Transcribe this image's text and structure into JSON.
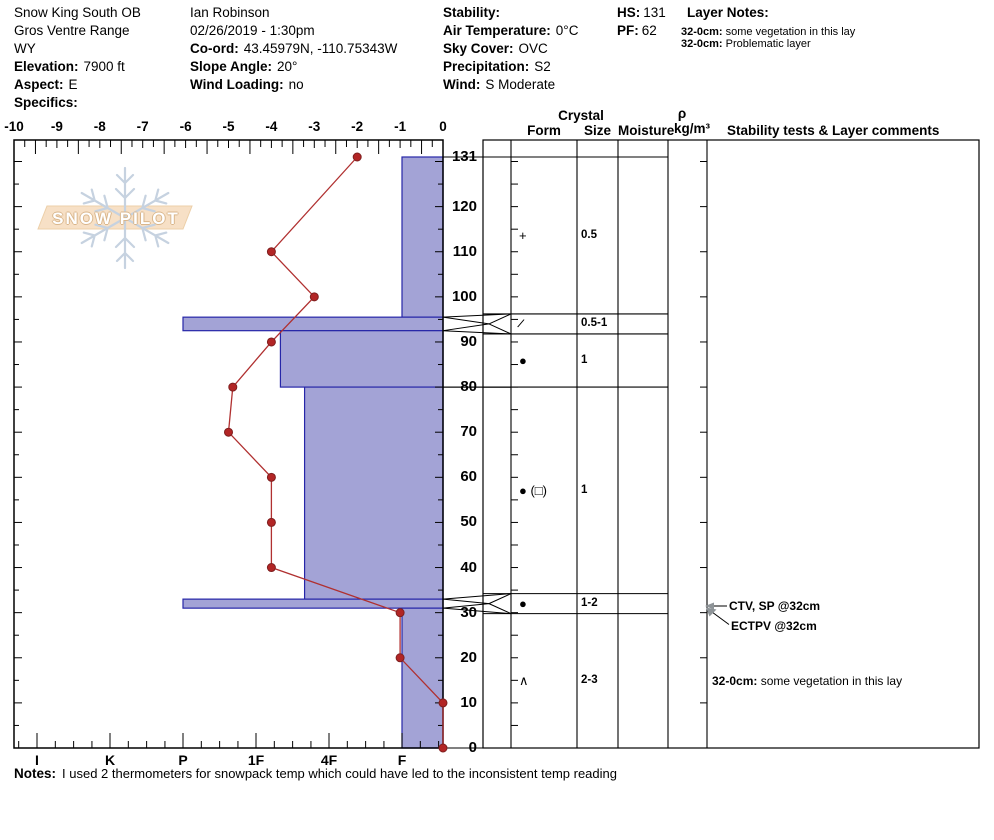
{
  "header": {
    "location": {
      "name": "Snow King South OB",
      "range": "Gros Ventre Range",
      "state": "WY",
      "elevation_label": "Elevation:",
      "elevation": "7900 ft",
      "aspect_label": "Aspect:",
      "aspect": "E",
      "specifics_label": "Specifics:",
      "specifics": ""
    },
    "observer": {
      "name": "Ian Robinson",
      "datetime": "02/26/2019 - 1:30pm",
      "coord_label": "Co-ord:",
      "coord": "43.45979N, -110.75343W",
      "slope_label": "Slope Angle:",
      "slope": "20°",
      "wind_loading_label": "Wind Loading:",
      "wind_loading": "no"
    },
    "conditions": {
      "stability_label": "Stability:",
      "stability": "",
      "air_temp_label": "Air Temperature:",
      "air_temp": "0°C",
      "sky_label": "Sky Cover:",
      "sky": "OVC",
      "precip_label": "Precipitation:",
      "precip": "S2",
      "wind_label": "Wind:",
      "wind": "S Moderate"
    },
    "snowpack": {
      "hs_label": "HS:",
      "hs": "131",
      "pf_label": "PF:",
      "pf": "62"
    },
    "layer_notes": {
      "title": "Layer Notes:",
      "notes": [
        {
          "label": "32-0cm:",
          "text": "some vegetation in this lay"
        },
        {
          "label": "32-0cm:",
          "text": "Problematic layer"
        }
      ]
    }
  },
  "watermark": {
    "text": "SNOW PILOT"
  },
  "table_headers": {
    "crystal": "Crystal",
    "form": "Form",
    "size": "Size",
    "moisture": "Moisture",
    "density_symbol": "ρ",
    "density_unit": "kg/m³",
    "comments": "Stability tests & Layer comments"
  },
  "chart_data": {
    "type": "snow-profile",
    "temperature_axis": {
      "unit": "°C",
      "min": -10,
      "max": 0,
      "ticks": [
        -10,
        -9,
        -8,
        -7,
        -6,
        -5,
        -4,
        -3,
        -2,
        -1,
        0
      ]
    },
    "hardness_axis": {
      "labels": [
        "I",
        "K",
        "P",
        "1F",
        "4F",
        "F"
      ]
    },
    "height_axis": {
      "unit": "cm",
      "min": 0,
      "max": 131,
      "labels": [
        131,
        120,
        110,
        100,
        90,
        80,
        70,
        60,
        50,
        40,
        30,
        20,
        10,
        0
      ]
    },
    "temperature_profile": [
      {
        "height": 131,
        "temp": -2
      },
      {
        "height": 110,
        "temp": -4
      },
      {
        "height": 100,
        "temp": -3
      },
      {
        "height": 90,
        "temp": -4
      },
      {
        "height": 80,
        "temp": -4.9
      },
      {
        "height": 70,
        "temp": -5
      },
      {
        "height": 60,
        "temp": -4
      },
      {
        "height": 50,
        "temp": -4
      },
      {
        "height": 40,
        "temp": -4
      },
      {
        "height": 30,
        "temp": -1
      },
      {
        "height": 20,
        "temp": -1
      },
      {
        "height": 10,
        "temp": 0
      },
      {
        "height": 0,
        "temp": 0
      }
    ],
    "layers": [
      {
        "top": 131,
        "bottom": 95.5,
        "hardness": "F",
        "form": "+",
        "size": "0.5"
      },
      {
        "top": 95.5,
        "bottom": 92.5,
        "hardness": "P",
        "form": "/",
        "size": "0.5-1"
      },
      {
        "top": 92.5,
        "bottom": 80,
        "hardness": "1F-",
        "form": "●",
        "size": "1"
      },
      {
        "top": 80,
        "bottom": 33,
        "hardness": "4F+",
        "form": "● (□)",
        "size": "1"
      },
      {
        "top": 33,
        "bottom": 31,
        "hardness": "P",
        "form": "●",
        "size": "1-2"
      },
      {
        "top": 31,
        "bottom": 0,
        "hardness": "F",
        "form": "∧",
        "size": "2-3",
        "comment_label": "32-0cm:",
        "comment_text": "some vegetation in this lay"
      }
    ],
    "stability_tests": [
      {
        "text": "CTV, SP @32cm",
        "depth_cm": 32
      },
      {
        "text": "ECTPV @32cm",
        "depth_cm": 32
      }
    ],
    "colors": {
      "bar_fill": "#a3a3d6",
      "bar_border": "#2626a8",
      "temp_line": "#b03030",
      "temp_dot": "#b22525",
      "temp_dot_edge": "#7e1f1f",
      "watermark_flake": "#c6d2e0",
      "watermark_banner": "#f7e0c6",
      "watermark_banner_edge": "#eccfa8",
      "arrow": "#8e9498"
    }
  },
  "footer": {
    "label": "Notes:",
    "text": "I used 2 thermometers for snowpack temp which could have led to the inconsistent temp reading"
  }
}
